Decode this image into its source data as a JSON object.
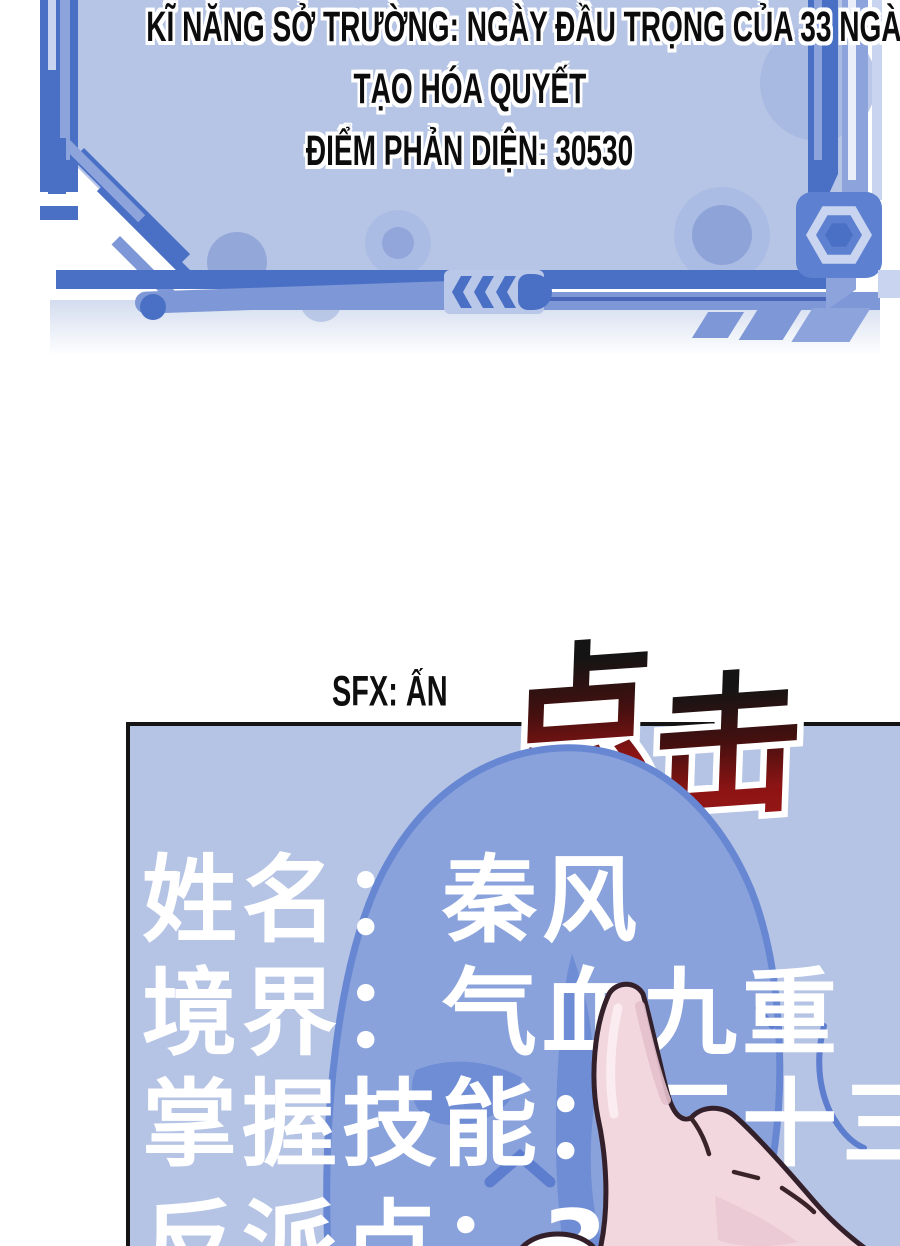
{
  "status_panel": {
    "lines": [
      "KĨ NĂNG SỞ TRƯỜNG: NGÀY ĐẦU TRỌNG CỦA 33 NGÀY",
      "TẠO HÓA QUYẾT",
      "ĐIỂM PHẢN DIỆN: 30530"
    ],
    "villain_points": "30530",
    "colors": {
      "fill": "#b6c5e5",
      "frame": "#4a70c5",
      "frame_mid": "#7e97d6",
      "frame_light": "#8ca3dc",
      "frame_pale": "#c9d5f0"
    }
  },
  "sfx": {
    "label": "SFX: ẤN",
    "click_char_1": "点",
    "click_char_2": "击",
    "gradient_top": "#141414",
    "gradient_bottom": "#8d1414"
  },
  "stats_panel": {
    "rows": [
      "姓名：秦风",
      "境界：气血九重（",
      "掌握技能：三十三",
      "反派点：30"
    ],
    "colors": {
      "fill": "#b5c3e4",
      "head": "#8aa2db",
      "head_outline": "#6787d3",
      "shade": "#6e8cd4",
      "text": "#ffffff",
      "border": "#141414"
    }
  },
  "hand": {
    "skin": "#f2d8de",
    "shade": "#e3c0cc",
    "outline": "#33202a",
    "nail": "#ffffff"
  }
}
